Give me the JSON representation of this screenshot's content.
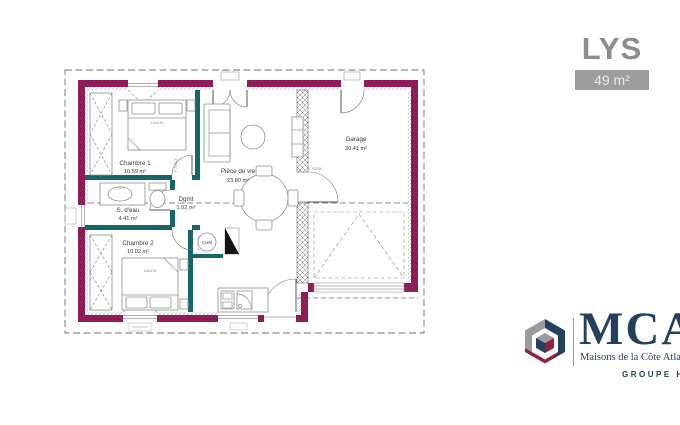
{
  "header": {
    "title": "LYS",
    "area_badge": "49 m²"
  },
  "plan": {
    "rooms": [
      {
        "name": "Chambre 1",
        "area": "10.59 m²"
      },
      {
        "name": "S. d'eau",
        "area": "4.41 m²"
      },
      {
        "name": "Dgmt",
        "area": "1.02 m²"
      },
      {
        "name": "Chambre 2",
        "area": "10.02 m²"
      },
      {
        "name": "Pièce de vie",
        "area": "23.80 m²"
      },
      {
        "name": "Garage",
        "area": "20.41 m²"
      }
    ],
    "annotations": {
      "water_heater": "CUM",
      "bed1_size": "140x190",
      "bed2_size": "140x190",
      "door_label_garage": "P 75/204",
      "door_label_hall": "P 70/204"
    },
    "colors": {
      "wall": "#8e1d58",
      "partition": "#15666b",
      "furniture": "#8f8f8f"
    }
  },
  "logo": {
    "brand": "MCA",
    "tagline": "Maisons de la Côte Atlantique",
    "group": "GROUPE HEXAOM",
    "navy": "#23405e",
    "maroon": "#8c2340",
    "gray": "#9a9aa0"
  }
}
